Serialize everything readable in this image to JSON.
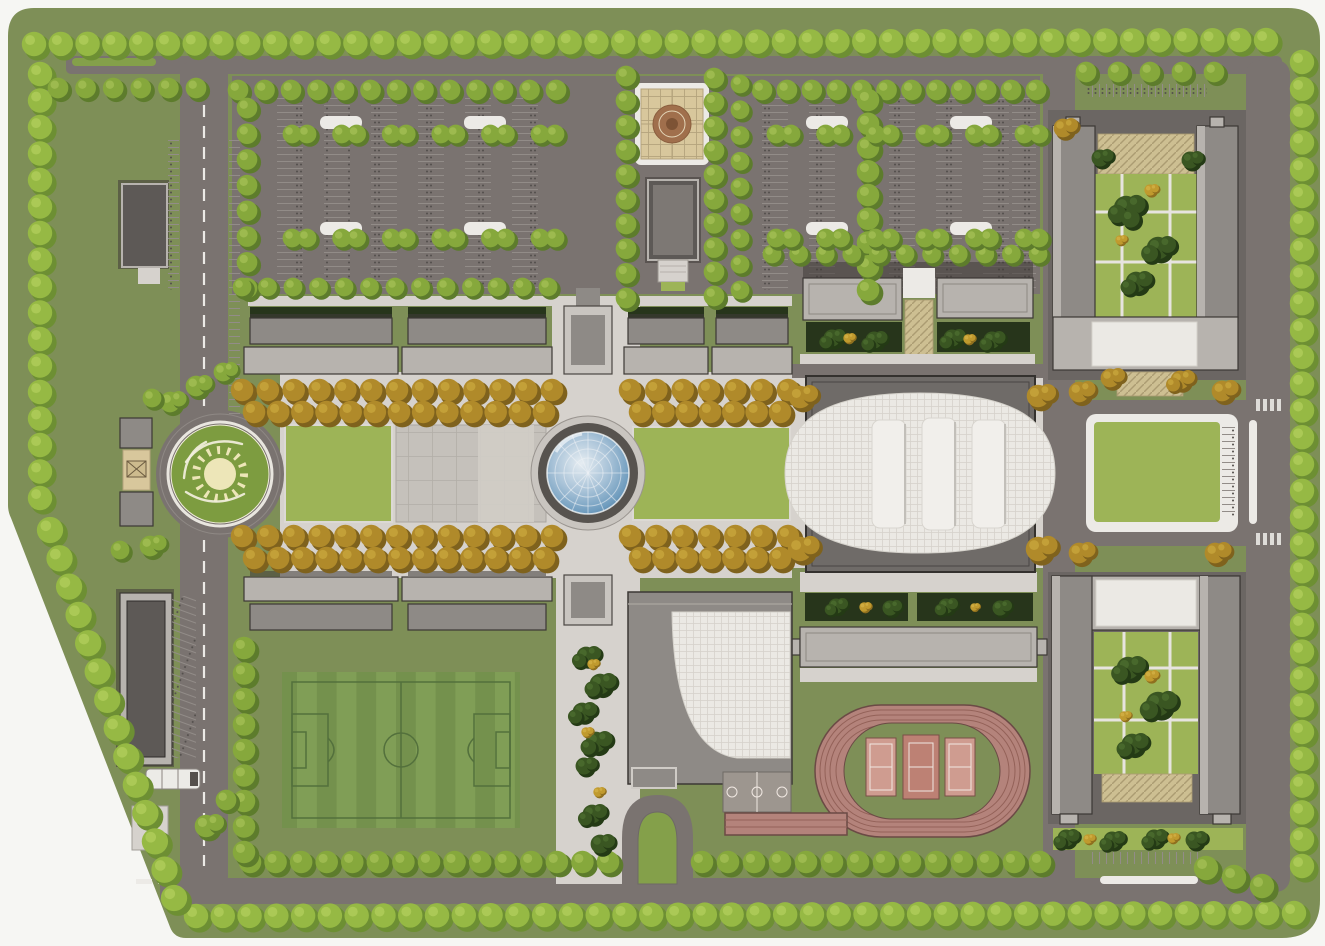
{
  "meta": {
    "title": "Campus master plan aerial site rendering",
    "width": 1325,
    "height": 946
  },
  "palette": {
    "page": "#f6f6f3",
    "grass": "#7e8f57",
    "lawn": "#9db457",
    "island": "#84a04a",
    "road": "#7a7370",
    "road_line": "#8f8985",
    "sidewalk": "#d6d2cd",
    "tile": "#c5c1bb",
    "tile_light": "#d0cdc7",
    "tile_line": "#b2aea7",
    "bld_light": "#b7b3ae",
    "bld_mid": "#8e8a86",
    "bld_dark": "#5d5956",
    "bld_edge": "#8d8883",
    "plinth": "#6b6663",
    "outline": "#3c3835",
    "shadow": "#3f3b38",
    "roof_white": "#ebe9e4",
    "roof_line": "#d5d2cb",
    "tan": "#d8c79c",
    "tan_line": "#b4a37c",
    "medallion": "#a06f4c",
    "medallion_dark": "#7d5335",
    "hatch_bg": "#cdbf92",
    "hatch_line": "#ab9c72",
    "hedge": "#27351b",
    "track": "#b4837b",
    "track_line": "#936158",
    "track_edge": "#6b4a45",
    "court_pink": "#cf9c90",
    "court_mid": "#bd8174",
    "court_line": "#f0e8e2",
    "court_gray": "#9d968f",
    "field_a": "#74914d",
    "field_b": "#809e56",
    "field_line": "#53703c",
    "emblem_green": "#7d9c40",
    "emblem_pale": "#ede6b8",
    "emblem_line": "#f2efdd",
    "white_line": "#eceae6",
    "stall_line": "#928c88",
    "stall_dot": "#534f4c",
    "dome_hi": "#e6edf2",
    "dome_mid": "#a9c3d8",
    "dome_deep": "#6f9cbe",
    "dome_edge": "#4a7499",
    "tree_green": "#86a83c",
    "tree_lime": "#96b944",
    "tree_autumn": "#b08a2a",
    "shrub_dark": "#3a5622"
  },
  "features": [
    {
      "name": "perimeter-tree-belt",
      "kind": "vegetation"
    },
    {
      "name": "entrance-roundabout-sun-emblem",
      "kind": "road"
    },
    {
      "name": "main-gate",
      "kind": "building"
    },
    {
      "name": "north-parking-lot-west",
      "kind": "parking"
    },
    {
      "name": "north-parking-lot-east",
      "kind": "parking"
    },
    {
      "name": "entrance-plaza-compass-medallion",
      "kind": "plaza"
    },
    {
      "name": "gatehouse-building",
      "kind": "building"
    },
    {
      "name": "north-academic-row",
      "kind": "building"
    },
    {
      "name": "south-academic-row",
      "kind": "building"
    },
    {
      "name": "central-glass-dome",
      "kind": "landmark"
    },
    {
      "name": "oval-assembly-hall",
      "kind": "building"
    },
    {
      "name": "curved-roof-building",
      "kind": "building"
    },
    {
      "name": "northeast-courtyard-building",
      "kind": "building"
    },
    {
      "name": "southeast-courtyard-building",
      "kind": "building"
    },
    {
      "name": "northeast-lawn",
      "kind": "lawn"
    },
    {
      "name": "west-lawn",
      "kind": "lawn"
    },
    {
      "name": "east-lawn",
      "kind": "lawn"
    },
    {
      "name": "paved-tile-plaza",
      "kind": "plaza"
    },
    {
      "name": "soccer-field",
      "kind": "sports"
    },
    {
      "name": "running-track",
      "kind": "sports"
    },
    {
      "name": "tennis-courts",
      "kind": "sports",
      "count": 3
    },
    {
      "name": "basketball-court",
      "kind": "sports"
    },
    {
      "name": "sprint-straight",
      "kind": "sports"
    },
    {
      "name": "turnaround-loop",
      "kind": "road"
    },
    {
      "name": "service-building-north",
      "kind": "building"
    },
    {
      "name": "service-building-south",
      "kind": "building"
    },
    {
      "name": "shuttle-bus",
      "kind": "vehicle"
    },
    {
      "name": "garden-beds",
      "kind": "vegetation"
    }
  ],
  "vegetation": {
    "rows": [
      {
        "t": "lime",
        "x1": 34,
        "y1": 44,
        "x2": 1266,
        "y2": 40,
        "s": 27,
        "r": 13
      },
      {
        "t": "lime",
        "x1": 1302,
        "y1": 62,
        "x2": 1302,
        "y2": 866,
        "s": 27,
        "r": 13
      },
      {
        "t": "lime",
        "x1": 196,
        "y1": 916,
        "x2": 1294,
        "y2": 913,
        "s": 27,
        "r": 13
      },
      {
        "t": "lime",
        "x1": 40,
        "y1": 74,
        "x2": 40,
        "y2": 498,
        "s": 27,
        "r": 13
      },
      {
        "t": "lime",
        "x1": 50,
        "y1": 530,
        "x2": 174,
        "y2": 898,
        "s": 29,
        "r": 14
      },
      {
        "t": "green",
        "x1": 58,
        "y1": 88,
        "x2": 196,
        "y2": 88,
        "s": 26,
        "r": 11
      },
      {
        "t": "green",
        "x1": 238,
        "y1": 90,
        "x2": 556,
        "y2": 90,
        "s": 26,
        "r": 11
      },
      {
        "t": "green",
        "x1": 762,
        "y1": 90,
        "x2": 1036,
        "y2": 90,
        "s": 26,
        "r": 11
      },
      {
        "t": "green",
        "x1": 247,
        "y1": 108,
        "x2": 247,
        "y2": 288,
        "s": 26,
        "r": 11
      },
      {
        "t": "green",
        "x1": 868,
        "y1": 100,
        "x2": 868,
        "y2": 290,
        "s": 25,
        "r": 12
      },
      {
        "t": "green",
        "x1": 626,
        "y1": 76,
        "x2": 626,
        "y2": 298,
        "s": 25,
        "r": 11
      },
      {
        "t": "green",
        "x1": 714,
        "y1": 78,
        "x2": 714,
        "y2": 296,
        "s": 25,
        "r": 11
      },
      {
        "t": "green",
        "x1": 740,
        "y1": 84,
        "x2": 740,
        "y2": 290,
        "s": 26,
        "r": 10
      },
      {
        "t": "green",
        "x1": 1086,
        "y1": 72,
        "x2": 1214,
        "y2": 72,
        "s": 30,
        "r": 11
      },
      {
        "t": "green",
        "x1": 250,
        "y1": 862,
        "x2": 608,
        "y2": 862,
        "s": 26,
        "r": 12
      },
      {
        "t": "green",
        "x1": 702,
        "y1": 862,
        "x2": 1040,
        "y2": 862,
        "s": 26,
        "r": 12
      },
      {
        "t": "green",
        "x1": 1206,
        "y1": 868,
        "x2": 1262,
        "y2": 886,
        "s": 26,
        "r": 13
      },
      {
        "t": "green",
        "x1": 244,
        "y1": 648,
        "x2": 244,
        "y2": 852,
        "s": 26,
        "r": 12
      },
      {
        "t": "green",
        "x1": 242,
        "y1": 287,
        "x2": 548,
        "y2": 287,
        "s": 26,
        "r": 10
      },
      {
        "t": "green",
        "x1": 772,
        "y1": 254,
        "x2": 1038,
        "y2": 254,
        "s": 26,
        "r": 10
      },
      {
        "t": "autumn",
        "x1": 242,
        "y1": 390,
        "x2": 552,
        "y2": 390,
        "s": 25,
        "r": 12
      },
      {
        "t": "autumn",
        "x1": 254,
        "y1": 412,
        "x2": 544,
        "y2": 412,
        "s": 25,
        "r": 12
      },
      {
        "t": "autumn",
        "x1": 630,
        "y1": 390,
        "x2": 788,
        "y2": 390,
        "s": 25,
        "r": 12
      },
      {
        "t": "autumn",
        "x1": 640,
        "y1": 412,
        "x2": 780,
        "y2": 412,
        "s": 25,
        "r": 12
      },
      {
        "t": "autumn",
        "x1": 242,
        "y1": 536,
        "x2": 552,
        "y2": 536,
        "s": 25,
        "r": 12
      },
      {
        "t": "autumn",
        "x1": 254,
        "y1": 558,
        "x2": 544,
        "y2": 558,
        "s": 25,
        "r": 12
      },
      {
        "t": "autumn",
        "x1": 630,
        "y1": 536,
        "x2": 788,
        "y2": 536,
        "s": 25,
        "r": 12
      },
      {
        "t": "autumn",
        "x1": 640,
        "y1": 558,
        "x2": 780,
        "y2": 558,
        "s": 25,
        "r": 12
      },
      {
        "t": "green",
        "x1": 292,
        "y1": 134,
        "x2": 540,
        "y2": 134,
        "s": 47,
        "r": 10,
        "pair": true
      },
      {
        "t": "green",
        "x1": 292,
        "y1": 238,
        "x2": 540,
        "y2": 238,
        "s": 47,
        "r": 10,
        "pair": true
      },
      {
        "t": "green",
        "x1": 776,
        "y1": 134,
        "x2": 1024,
        "y2": 134,
        "s": 47,
        "r": 10,
        "pair": true
      },
      {
        "t": "green",
        "x1": 776,
        "y1": 238,
        "x2": 1024,
        "y2": 238,
        "s": 47,
        "r": 10,
        "pair": true
      }
    ],
    "clusters": [
      {
        "t": "autumn",
        "x": 800,
        "y": 397,
        "r": 12,
        "n": 2
      },
      {
        "t": "autumn",
        "x": 800,
        "y": 549,
        "r": 13,
        "n": 2
      },
      {
        "t": "autumn",
        "x": 1038,
        "y": 396,
        "r": 12,
        "n": 2
      },
      {
        "t": "autumn",
        "x": 1038,
        "y": 549,
        "r": 13,
        "n": 2
      },
      {
        "t": "autumn",
        "x": 1079,
        "y": 392,
        "r": 11,
        "n": 2
      },
      {
        "t": "autumn",
        "x": 1222,
        "y": 391,
        "r": 11,
        "n": 2
      },
      {
        "t": "autumn",
        "x": 1079,
        "y": 553,
        "r": 11,
        "n": 2
      },
      {
        "t": "autumn",
        "x": 1215,
        "y": 553,
        "r": 11,
        "n": 2
      },
      {
        "t": "autumn",
        "x": 1063,
        "y": 128,
        "r": 10,
        "n": 2
      },
      {
        "t": "autumn",
        "x": 1110,
        "y": 378,
        "r": 10,
        "n": 2
      },
      {
        "t": "autumn",
        "x": 1180,
        "y": 380,
        "r": 10,
        "n": 3
      },
      {
        "t": "shrub",
        "x": 1126,
        "y": 208,
        "r": 13,
        "n": 4
      },
      {
        "t": "shrub",
        "x": 1158,
        "y": 248,
        "r": 12,
        "n": 3
      },
      {
        "t": "shrub",
        "x": 1136,
        "y": 282,
        "r": 11,
        "n": 3
      },
      {
        "t": "gold",
        "x": 1150,
        "y": 190,
        "r": 6,
        "n": 2
      },
      {
        "t": "gold",
        "x": 1120,
        "y": 240,
        "r": 5,
        "n": 2
      },
      {
        "t": "shrub",
        "x": 1100,
        "y": 158,
        "r": 9,
        "n": 2
      },
      {
        "t": "shrub",
        "x": 1190,
        "y": 160,
        "r": 9,
        "n": 2
      },
      {
        "t": "shrub",
        "x": 1128,
        "y": 668,
        "r": 12,
        "n": 3
      },
      {
        "t": "shrub",
        "x": 1158,
        "y": 704,
        "r": 13,
        "n": 3
      },
      {
        "t": "shrub",
        "x": 1132,
        "y": 744,
        "r": 11,
        "n": 3
      },
      {
        "t": "gold",
        "x": 1150,
        "y": 676,
        "r": 6,
        "n": 2
      },
      {
        "t": "gold",
        "x": 1124,
        "y": 716,
        "r": 5,
        "n": 2
      },
      {
        "t": "shrub",
        "x": 586,
        "y": 656,
        "r": 10,
        "n": 3
      },
      {
        "t": "shrub",
        "x": 600,
        "y": 684,
        "r": 11,
        "n": 3
      },
      {
        "t": "shrub",
        "x": 582,
        "y": 712,
        "r": 10,
        "n": 3
      },
      {
        "t": "shrub",
        "x": 596,
        "y": 742,
        "r": 11,
        "n": 3
      },
      {
        "t": "shrub",
        "x": 584,
        "y": 766,
        "r": 9,
        "n": 2
      },
      {
        "t": "shrub",
        "x": 592,
        "y": 814,
        "r": 10,
        "n": 3
      },
      {
        "t": "shrub",
        "x": 600,
        "y": 844,
        "r": 10,
        "n": 2
      },
      {
        "t": "gold",
        "x": 592,
        "y": 664,
        "r": 5,
        "n": 2
      },
      {
        "t": "gold",
        "x": 586,
        "y": 732,
        "r": 5,
        "n": 2
      },
      {
        "t": "gold",
        "x": 598,
        "y": 792,
        "r": 5,
        "n": 2
      },
      {
        "t": "shrub",
        "x": 832,
        "y": 338,
        "r": 9,
        "n": 3
      },
      {
        "t": "shrub",
        "x": 874,
        "y": 340,
        "r": 9,
        "n": 3
      },
      {
        "t": "shrub",
        "x": 952,
        "y": 338,
        "r": 9,
        "n": 3
      },
      {
        "t": "shrub",
        "x": 992,
        "y": 340,
        "r": 9,
        "n": 3
      },
      {
        "t": "gold",
        "x": 848,
        "y": 338,
        "r": 5,
        "n": 2
      },
      {
        "t": "gold",
        "x": 968,
        "y": 339,
        "r": 5,
        "n": 2
      },
      {
        "t": "shrub",
        "x": 836,
        "y": 606,
        "r": 8,
        "n": 3
      },
      {
        "t": "shrub",
        "x": 890,
        "y": 608,
        "r": 8,
        "n": 2
      },
      {
        "t": "shrub",
        "x": 946,
        "y": 606,
        "r": 8,
        "n": 3
      },
      {
        "t": "shrub",
        "x": 1000,
        "y": 608,
        "r": 8,
        "n": 2
      },
      {
        "t": "gold",
        "x": 864,
        "y": 607,
        "r": 5,
        "n": 2
      },
      {
        "t": "gold",
        "x": 974,
        "y": 607,
        "r": 4,
        "n": 2
      },
      {
        "t": "shrub",
        "x": 1066,
        "y": 838,
        "r": 9,
        "n": 3
      },
      {
        "t": "shrub",
        "x": 1112,
        "y": 840,
        "r": 9,
        "n": 3
      },
      {
        "t": "shrub",
        "x": 1154,
        "y": 838,
        "r": 9,
        "n": 3
      },
      {
        "t": "shrub",
        "x": 1194,
        "y": 840,
        "r": 9,
        "n": 2
      },
      {
        "t": "gold",
        "x": 1088,
        "y": 839,
        "r": 5,
        "n": 2
      },
      {
        "t": "gold",
        "x": 1172,
        "y": 838,
        "r": 5,
        "n": 2
      },
      {
        "t": "green",
        "x": 170,
        "y": 402,
        "r": 11,
        "n": 2
      },
      {
        "t": "green",
        "x": 196,
        "y": 386,
        "r": 11,
        "n": 2
      },
      {
        "t": "green",
        "x": 223,
        "y": 372,
        "r": 10,
        "n": 2
      },
      {
        "t": "green",
        "x": 152,
        "y": 398,
        "r": 10,
        "n": 1
      },
      {
        "t": "green",
        "x": 150,
        "y": 546,
        "r": 11,
        "n": 2
      },
      {
        "t": "green",
        "x": 120,
        "y": 550,
        "r": 10,
        "n": 1
      },
      {
        "t": "green",
        "x": 206,
        "y": 826,
        "r": 12,
        "n": 2
      },
      {
        "t": "green",
        "x": 226,
        "y": 800,
        "r": 11,
        "n": 1
      }
    ]
  }
}
